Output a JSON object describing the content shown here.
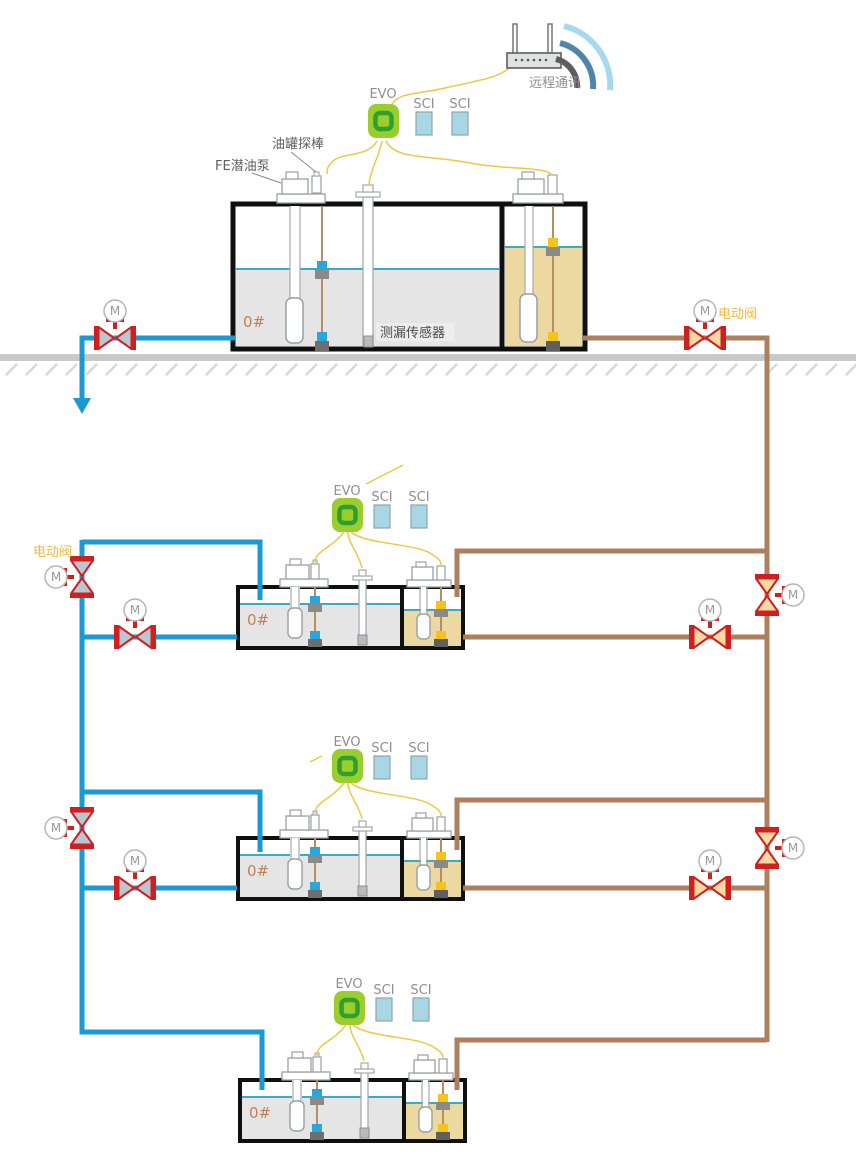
{
  "diagram": {
    "remote_comm": {
      "label": "远程通讯"
    },
    "annotations": {
      "tank_probe": "油罐探棒",
      "fe_pump": "FE潜油泵",
      "leak_sensor": "测漏传感器",
      "electric_valve": "电动阀",
      "motor": "M"
    },
    "stations": [
      {
        "controller": "EVO",
        "modules": [
          "SCI",
          "SCI"
        ],
        "fuel_grade": "0#"
      },
      {
        "controller": "EVO",
        "modules": [
          "SCI",
          "SCI"
        ],
        "fuel_grade": "0#"
      },
      {
        "controller": "EVO",
        "modules": [
          "SCI",
          "SCI"
        ],
        "fuel_grade": "0#"
      },
      {
        "controller": "EVO",
        "modules": [
          "SCI",
          "SCI"
        ],
        "fuel_grade": "0#"
      }
    ],
    "colors": {
      "supply_pipe_blue": "#1b9ad2",
      "return_pipe_brown": "#ae7e5d",
      "valve_red": "#cf1f1f",
      "valve_fill_blue": "#b9c7d2",
      "valve_fill_tan": "#f7dba2",
      "evo_body_green": "#9ccd2f",
      "evo_ring_green": "#2ea02e",
      "sci_module_blue": "#a9d6e4",
      "diesel_liquid_gray": "#e5e5e6",
      "oil_liquid_tan": "#ecd9a2",
      "liquid_surface_teal": "#3aabc6",
      "signal_wire_yellow": "#eec844",
      "ground_gray": "#c9c9c9",
      "float_blue": "#2aa7d8",
      "float_yellow": "#f4c41c"
    },
    "icons": {
      "router": "wireless-router-icon",
      "wifi": "wifi-signal-icon",
      "controller": "evo-controller-icon",
      "module": "sci-module-icon",
      "valve": "motorized-valve-icon",
      "motor_badge": "motor-circle-icon",
      "flow_arrow": "flow-arrow-down-icon"
    }
  }
}
